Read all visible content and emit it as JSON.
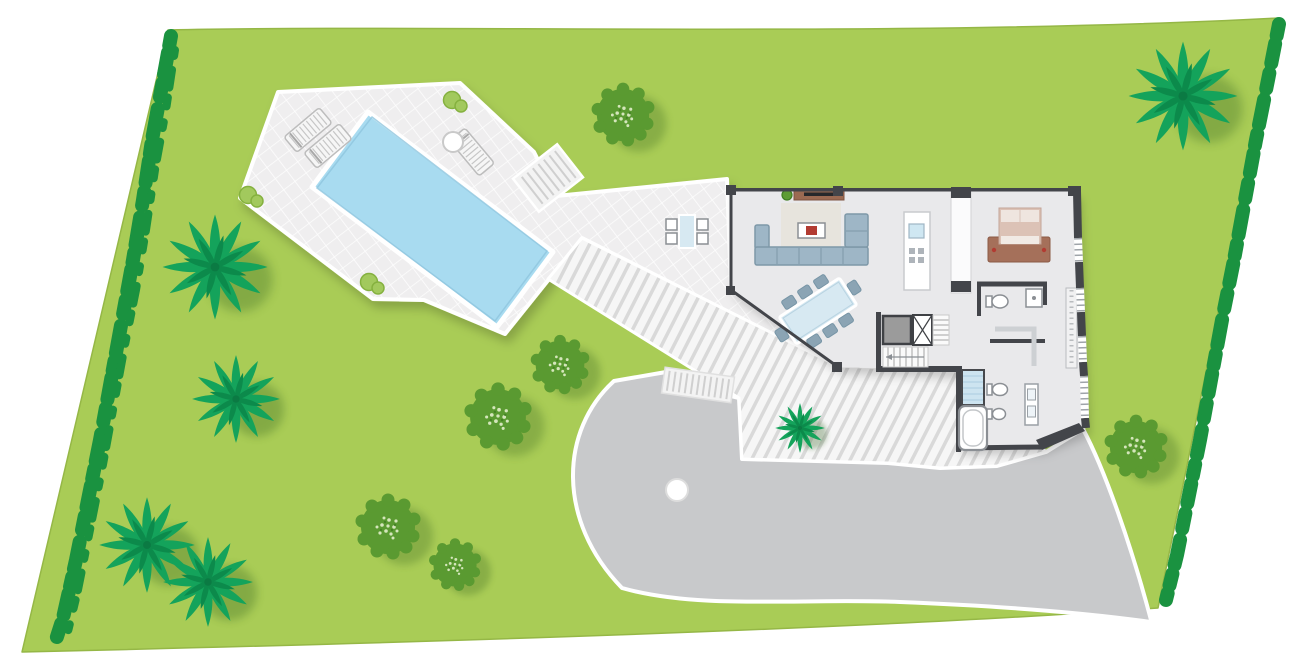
{
  "meta": {
    "title": "Villa site plan - ground floor with pool terrace, garden and driveway",
    "drawing_type": "architectural site plan, top view",
    "visible_text": "none"
  },
  "colors": {
    "lawn": "#a9cc56",
    "lawn_edge": "#95b746",
    "hedge": "#1a9240",
    "tree": "#5a9a31",
    "tree_speckle": "#dcebc4",
    "palm": "#14a35b",
    "palm_dark": "#0c8a4b",
    "terrace_tile": "#efeeef",
    "pool": "#a8dbf0",
    "deck_board": "#f6f6f6",
    "deck_gap": "#d9d9d9",
    "house_floor": "#e9e9eb",
    "wall": "#43454a",
    "window_tick": "#9fa4a9",
    "partition": "#fbfbfc",
    "sofa": "#9eb6c6",
    "sofa_line": "#7e98a8",
    "rug": "#e7e4dd",
    "wood": "#9b6a52",
    "tv_dark": "#26282b",
    "accent_red": "#b23b32",
    "glass_blue": "#d7e9f2",
    "chair": "#8ba4b4",
    "bed_frame": "#a5705a",
    "mattress": "#dcc2b6",
    "pillow": "#efe5df",
    "driveway": "#c8c9cb",
    "curb": "#ffffff",
    "elevator": "#9b9b9b",
    "fixture_line": "#8b8f94",
    "shower": "#cde4f0",
    "sink_blue": "#cfe7f2"
  },
  "counts": {
    "sun_loungers": 3,
    "dining_chairs": 8,
    "outdoor_chairs": 4,
    "round_trees": 6,
    "palm_trees": 6,
    "terrace_bushes": 3,
    "bedrooms_visible": 1,
    "bathrooms_visible": 2,
    "bathtubs": 1,
    "showers": 2,
    "elevators": 1
  },
  "site_features": [
    "sloped lawn parcel with hedge boundaries left and right",
    "pool terrace with rectangular swimming pool and loungers",
    "slatted boardwalk deck from terrace to villa entrance",
    "villa: living room, dining area, kitchen island, bedroom, two bathrooms, stair and elevator core",
    "gray driveway with turning circle and exit at lower right",
    "exterior steps from walkway down to driveway"
  ],
  "vegetation": {
    "trees": [
      {
        "x": 623,
        "y": 115,
        "r": 29
      },
      {
        "x": 560,
        "y": 365,
        "r": 27
      },
      {
        "x": 498,
        "y": 417,
        "r": 31
      },
      {
        "x": 388,
        "y": 527,
        "r": 30
      },
      {
        "x": 455,
        "y": 565,
        "r": 24
      },
      {
        "x": 1136,
        "y": 447,
        "r": 29
      }
    ],
    "palms": [
      {
        "x": 215,
        "y": 267,
        "r": 55
      },
      {
        "x": 236,
        "y": 399,
        "r": 46
      },
      {
        "x": 147,
        "y": 545,
        "r": 50
      },
      {
        "x": 208,
        "y": 582,
        "r": 47
      },
      {
        "x": 1183,
        "y": 96,
        "r": 57
      },
      {
        "x": 800,
        "y": 428,
        "r": 26
      }
    ]
  },
  "terrace_items": {
    "loungers": [
      {
        "x": 308,
        "y": 130,
        "rot": -40
      },
      {
        "x": 328,
        "y": 146,
        "rot": -40
      },
      {
        "x": 472,
        "y": 152,
        "rot": 50
      }
    ],
    "bushes": [
      {
        "x": 455,
        "y": 102
      },
      {
        "x": 372,
        "y": 284
      },
      {
        "x": 251,
        "y": 197
      }
    ],
    "side_table": {
      "x": 453,
      "y": 142
    }
  }
}
